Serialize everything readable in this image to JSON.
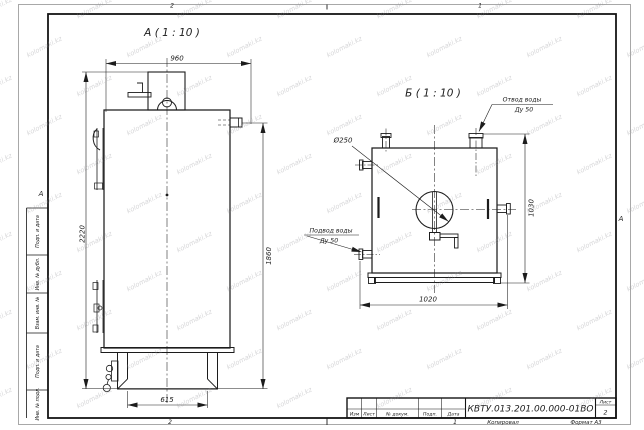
{
  "sheet": {
    "zone_top_left": "2",
    "zone_top_right": "1",
    "zone_bottom_left": "2",
    "zone_bottom_right": "1",
    "fold_mark_left": "А",
    "fold_mark_right": "А",
    "copy_label": "Копировал",
    "format_label": "Формат А3"
  },
  "watermark": {
    "text": "kolomaki.kz"
  },
  "stamp_column": {
    "items": [
      "Подп. и дата",
      "Инв. № дубл.",
      "Взам. инв. №",
      "Подп. и дата",
      "Инв. № подл."
    ]
  },
  "title_block": {
    "doc_number": "КВТУ.013.201.00.000-01ВО",
    "col_izm": "Изм",
    "col_list": "Лист",
    "col_doc": "№ докум.",
    "col_podp": "Подп.",
    "col_data": "Дата",
    "sheet_label": "Лист",
    "sheet_number": "2"
  },
  "view_a": {
    "title": "А ( 1 : 10 )",
    "dim_width": "960",
    "dim_height_overall": "2220",
    "dim_height_body": "1860",
    "dim_base_width": "615"
  },
  "view_b": {
    "title": "Б ( 1 : 10 )",
    "dim_width": "1020",
    "dim_height": "1030",
    "diameter": "Ø250",
    "outlet_line1": "Отвод воды",
    "outlet_line2": "Ду 50",
    "inlet_line1": "Подвод воды",
    "inlet_line2": "Ду 50"
  }
}
